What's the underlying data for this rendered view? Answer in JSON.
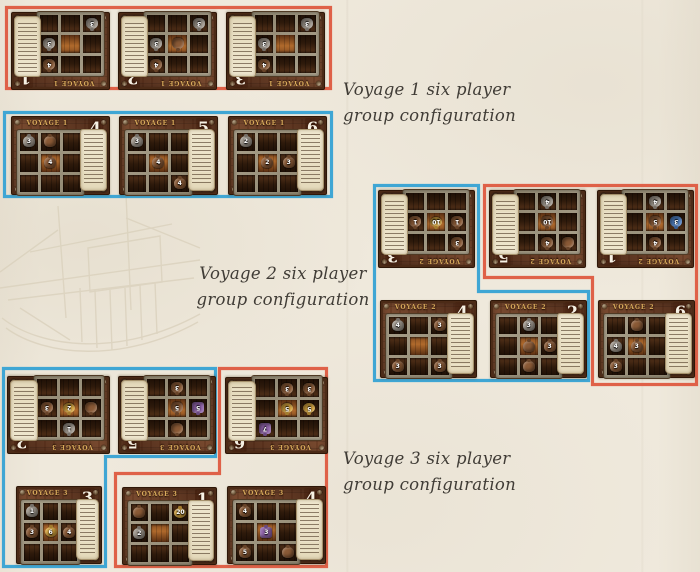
{
  "canvas": {
    "background": "#efe9dc"
  },
  "colors": {
    "group_red": "#df6148",
    "group_blue": "#3fa6d4",
    "caption_text": "#403c36",
    "board_wood": "#6b4026",
    "board_title_gold": "#d9ab5c",
    "board_number_white": "#f7f1e4",
    "parchment": "#ece3ca"
  },
  "goods_colors": {
    "gray": "#9e968c",
    "brown": "#8a5a36",
    "gold": "#d9a63e",
    "purple": "#8e62a8",
    "blue": "#4f7fc2"
  },
  "captions": [
    {
      "line1": "Voyage 1 six player",
      "line2": "group configuration"
    },
    {
      "line1": "Voyage 2 six player",
      "line2": "group configuration"
    },
    {
      "line1": "Voyage 3 six player",
      "line2": "group configuration"
    }
  ],
  "boards": [
    {
      "voyage": 1,
      "title": "VOYAGE 1",
      "num": "1",
      "rotated": true,
      "group": "red",
      "x": 11,
      "y": 12,
      "w": 97,
      "h": 76,
      "goods": [
        [
          2,
          0,
          "gray",
          "3"
        ],
        [
          1,
          2,
          "gray",
          "3"
        ],
        [
          0,
          2,
          "brown",
          "4"
        ]
      ]
    },
    {
      "voyage": 1,
      "title": "VOYAGE 1",
      "num": "2",
      "rotated": true,
      "group": "red",
      "x": 118,
      "y": 12,
      "w": 97,
      "h": 76,
      "goods": [
        [
          2,
          0,
          "gray",
          "3"
        ],
        [
          1,
          2,
          "gray",
          "3"
        ],
        [
          0,
          2,
          "brown",
          "4"
        ],
        [
          1,
          1,
          "brown",
          ""
        ]
      ]
    },
    {
      "voyage": 1,
      "title": "VOYAGE 1",
      "num": "3",
      "rotated": true,
      "group": "red",
      "x": 226,
      "y": 12,
      "w": 97,
      "h": 76,
      "goods": [
        [
          2,
          0,
          "gray",
          "3"
        ],
        [
          1,
          2,
          "gray",
          "3"
        ],
        [
          0,
          2,
          "brown",
          "4"
        ]
      ]
    },
    {
      "voyage": 1,
      "title": "VOYAGE 1",
      "num": "4",
      "rotated": false,
      "group": "blue",
      "x": 11,
      "y": 116,
      "w": 97,
      "h": 77,
      "goods": [
        [
          0,
          0,
          "gray",
          "3"
        ],
        [
          0,
          1,
          "brown",
          ""
        ],
        [
          1,
          1,
          "brown",
          "4"
        ]
      ]
    },
    {
      "voyage": 1,
      "title": "VOYAGE 1",
      "num": "5",
      "rotated": false,
      "group": "blue",
      "x": 119,
      "y": 116,
      "w": 97,
      "h": 77,
      "goods": [
        [
          0,
          0,
          "gray",
          "3"
        ],
        [
          1,
          1,
          "brown",
          "4"
        ],
        [
          2,
          2,
          "brown",
          "4"
        ]
      ]
    },
    {
      "voyage": 1,
      "title": "VOYAGE 1",
      "num": "6",
      "rotated": false,
      "group": "blue",
      "x": 228,
      "y": 116,
      "w": 97,
      "h": 77,
      "goods": [
        [
          0,
          0,
          "gray",
          "2"
        ],
        [
          1,
          1,
          "brown",
          "2"
        ],
        [
          1,
          2,
          "brown",
          "3"
        ]
      ]
    },
    {
      "voyage": 2,
      "title": "VOYAGE 2",
      "num": "3",
      "rotated": true,
      "group": "blue",
      "x": 378,
      "y": 190,
      "w": 95,
      "h": 76,
      "goods": [
        [
          1,
          0,
          "brown",
          "1"
        ],
        [
          1,
          1,
          "gold",
          "10"
        ],
        [
          1,
          2,
          "brown",
          "1"
        ],
        [
          0,
          0,
          "brown",
          "3"
        ]
      ]
    },
    {
      "voyage": 2,
      "title": "VOYAGE 2",
      "num": "5",
      "rotated": true,
      "group": "red",
      "x": 489,
      "y": 190,
      "w": 95,
      "h": 76,
      "goods": [
        [
          2,
          1,
          "gray",
          "4"
        ],
        [
          1,
          1,
          "brown",
          "10"
        ],
        [
          0,
          1,
          "brown",
          "4"
        ],
        [
          0,
          0,
          "brown",
          ""
        ]
      ]
    },
    {
      "voyage": 2,
      "title": "VOYAGE 2",
      "num": "1",
      "rotated": true,
      "group": "red",
      "x": 597,
      "y": 190,
      "w": 95,
      "h": 76,
      "goods": [
        [
          2,
          1,
          "gray",
          "4"
        ],
        [
          1,
          1,
          "brown",
          "5"
        ],
        [
          1,
          0,
          "blue",
          "3"
        ],
        [
          0,
          1,
          "brown",
          "4"
        ]
      ]
    },
    {
      "voyage": 2,
      "title": "VOYAGE 2",
      "num": "4",
      "rotated": false,
      "group": "blue",
      "x": 380,
      "y": 300,
      "w": 95,
      "h": 76,
      "goods": [
        [
          0,
          0,
          "gray",
          "4"
        ],
        [
          0,
          2,
          "brown",
          "3"
        ],
        [
          2,
          0,
          "brown",
          "3"
        ],
        [
          2,
          2,
          "brown",
          "3"
        ]
      ]
    },
    {
      "voyage": 2,
      "title": "VOYAGE 2",
      "num": "2",
      "rotated": false,
      "group": "blue",
      "x": 490,
      "y": 300,
      "w": 95,
      "h": 76,
      "goods": [
        [
          0,
          1,
          "gray",
          "3"
        ],
        [
          1,
          1,
          "brown",
          ""
        ],
        [
          1,
          2,
          "brown",
          "3"
        ],
        [
          2,
          1,
          "brown",
          ""
        ]
      ]
    },
    {
      "voyage": 2,
      "title": "VOYAGE 2",
      "num": "6",
      "rotated": false,
      "group": "red",
      "x": 598,
      "y": 300,
      "w": 95,
      "h": 76,
      "goods": [
        [
          0,
          1,
          "brown",
          ""
        ],
        [
          1,
          0,
          "gray",
          "4"
        ],
        [
          1,
          1,
          "brown",
          "3"
        ],
        [
          2,
          0,
          "brown",
          "3"
        ]
      ]
    },
    {
      "voyage": 3,
      "title": "VOYAGE 3",
      "num": "2",
      "rotated": true,
      "group": "blue",
      "x": 7,
      "y": 376,
      "w": 101,
      "h": 76,
      "goods": [
        [
          1,
          1,
          "gold",
          "2"
        ],
        [
          0,
          1,
          "gray",
          "1"
        ],
        [
          1,
          2,
          "brown",
          "3"
        ],
        [
          1,
          0,
          "brown",
          ""
        ]
      ]
    },
    {
      "voyage": 3,
      "title": "VOYAGE 3",
      "num": "5",
      "rotated": true,
      "group": "blue",
      "x": 118,
      "y": 376,
      "w": 96,
      "h": 76,
      "goods": [
        [
          1,
          0,
          "purple",
          "5"
        ],
        [
          1,
          1,
          "brown",
          "5"
        ],
        [
          2,
          1,
          "brown",
          "3"
        ],
        [
          0,
          1,
          "brown",
          ""
        ]
      ]
    },
    {
      "voyage": 3,
      "title": "VOYAGE 3",
      "num": "6",
      "rotated": true,
      "group": "red",
      "x": 225,
      "y": 377,
      "w": 101,
      "h": 75,
      "goods": [
        [
          2,
          1,
          "brown",
          "3"
        ],
        [
          2,
          0,
          "brown",
          "3"
        ],
        [
          1,
          1,
          "gold",
          "5"
        ],
        [
          1,
          0,
          "gold",
          "5"
        ],
        [
          0,
          2,
          "purple",
          "7"
        ]
      ]
    },
    {
      "voyage": 3,
      "title": "VOYAGE 3",
      "num": "3",
      "rotated": false,
      "group": "blue",
      "x": 16,
      "y": 486,
      "w": 84,
      "h": 76,
      "goods": [
        [
          0,
          0,
          "gray",
          "1"
        ],
        [
          1,
          0,
          "brown",
          "3"
        ],
        [
          1,
          1,
          "gold",
          "6"
        ],
        [
          1,
          2,
          "brown",
          "4"
        ]
      ]
    },
    {
      "voyage": 3,
      "title": "VOYAGE 3",
      "num": "1",
      "rotated": false,
      "group": "red",
      "x": 122,
      "y": 487,
      "w": 93,
      "h": 76,
      "goods": [
        [
          0,
          0,
          "brown",
          ""
        ],
        [
          0,
          2,
          "gold",
          "20"
        ],
        [
          1,
          0,
          "gray",
          "2"
        ]
      ]
    },
    {
      "voyage": 3,
      "title": "VOYAGE 3",
      "num": "4",
      "rotated": false,
      "group": "red",
      "x": 227,
      "y": 486,
      "w": 97,
      "h": 76,
      "goods": [
        [
          0,
          0,
          "brown",
          "4"
        ],
        [
          1,
          1,
          "purple",
          "3"
        ],
        [
          2,
          0,
          "brown",
          "5"
        ],
        [
          2,
          2,
          "brown",
          ""
        ]
      ]
    }
  ]
}
